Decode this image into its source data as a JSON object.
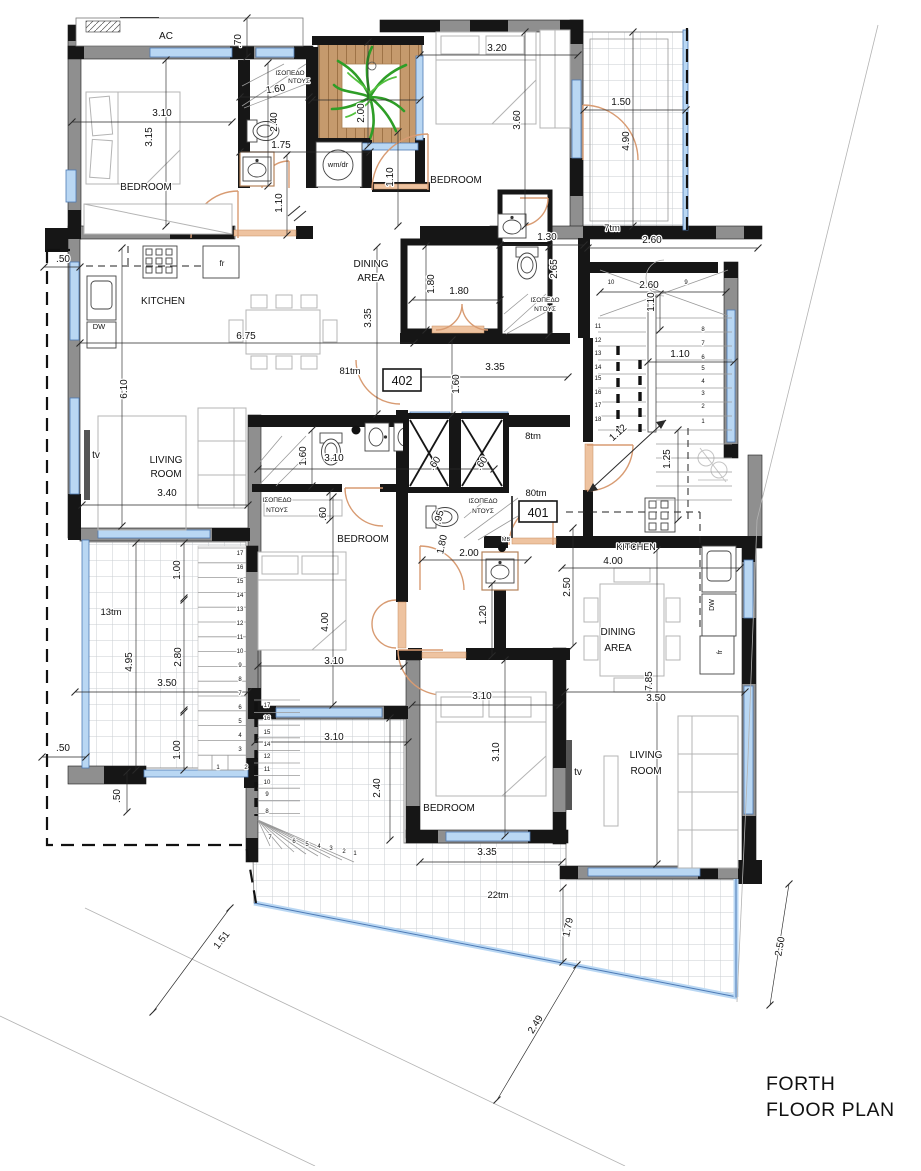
{
  "title": {
    "line1": "FORTH",
    "line2": "FLOOR PLAN"
  },
  "units": {
    "u402": "402",
    "u401": "401"
  },
  "colors": {
    "wall_gray": "#8f8f8f",
    "wall_black": "#161616",
    "window_blue": "#b9d7f3",
    "door_orange": "#d89b72",
    "deck_wood": "#c59a6d",
    "plant_green": "#2e9e27",
    "tile_line": "#c9cdd2",
    "dim_line": "#2a2a2a"
  },
  "labels": [
    {
      "n": "room-label-bedroom-nw",
      "t": "BEDROOM",
      "x": 146,
      "y": 190,
      "s": 10
    },
    {
      "n": "room-label-bedroom-ne",
      "t": "BEDROOM",
      "x": 456,
      "y": 183,
      "s": 10
    },
    {
      "n": "room-label-dining-402-1",
      "t": "DINING",
      "x": 371,
      "y": 267,
      "s": 10
    },
    {
      "n": "room-label-dining-402-2",
      "t": "AREA",
      "x": 371,
      "y": 281,
      "s": 10
    },
    {
      "n": "room-label-kitchen-402",
      "t": "KITCHEN",
      "x": 163,
      "y": 304,
      "s": 10
    },
    {
      "n": "room-label-living-402-1",
      "t": "LIVING",
      "x": 166,
      "y": 463,
      "s": 10
    },
    {
      "n": "room-label-living-402-2",
      "t": "ROOM",
      "x": 166,
      "y": 477,
      "s": 10
    },
    {
      "n": "room-label-bedroom-mid",
      "t": "BEDROOM",
      "x": 363,
      "y": 542,
      "s": 10
    },
    {
      "n": "room-label-kitchen-401",
      "t": "KITCHEN",
      "x": 636,
      "y": 550,
      "s": 9
    },
    {
      "n": "room-label-dining-401-1",
      "t": "DINING",
      "x": 618,
      "y": 635,
      "s": 10
    },
    {
      "n": "room-label-dining-401-2",
      "t": "AREA",
      "x": 618,
      "y": 651,
      "s": 10
    },
    {
      "n": "room-label-living-401-1",
      "t": "LIVING",
      "x": 646,
      "y": 758,
      "s": 10
    },
    {
      "n": "room-label-living-401-2",
      "t": "ROOM",
      "x": 646,
      "y": 774,
      "s": 10
    },
    {
      "n": "room-label-bedroom-s",
      "t": "BEDROOM",
      "x": 449,
      "y": 811,
      "s": 10
    },
    {
      "n": "fixture-label-ac",
      "t": "AC",
      "x": 166,
      "y": 39,
      "s": 10
    },
    {
      "n": "fixture-label-wmdr",
      "t": "wm/dr",
      "x": 338,
      "y": 167,
      "s": 7.5
    },
    {
      "n": "fixture-label-tv-402",
      "t": "tv",
      "x": 96,
      "y": 458,
      "s": 10
    },
    {
      "n": "fixture-label-tv-401",
      "t": "tv",
      "x": 578,
      "y": 775,
      "s": 10
    },
    {
      "n": "fixture-label-fr-402",
      "t": "fr",
      "x": 222,
      "y": 266,
      "s": 8
    },
    {
      "n": "fixture-label-fr-401",
      "t": "fr",
      "x": 722,
      "y": 652,
      "s": 7,
      "r": -90
    },
    {
      "n": "fixture-label-dw-402",
      "t": "DW",
      "x": 99,
      "y": 329,
      "s": 7.5
    },
    {
      "n": "fixture-label-dw-401",
      "t": "DW",
      "x": 714,
      "y": 605,
      "s": 7,
      "r": -90
    },
    {
      "n": "fixture-label-mb",
      "t": "MB",
      "x": 506,
      "y": 541,
      "s": 5.5
    },
    {
      "n": "shower-label-nw-1",
      "t": "ΙΣΟΠΕΔΟ",
      "x": 290,
      "y": 75,
      "s": 6.5
    },
    {
      "n": "shower-label-nw-2",
      "t": "ΝΤΟΥΣ",
      "x": 299,
      "y": 83,
      "s": 6.5
    },
    {
      "n": "shower-label-wc-1",
      "t": "ΙΣΟΠΕΔΟ",
      "x": 545,
      "y": 302,
      "s": 6.5
    },
    {
      "n": "shower-label-wc-2",
      "t": "ΝΤΟΥΣ",
      "x": 545,
      "y": 311,
      "s": 6.5
    },
    {
      "n": "shower-label-mid-1",
      "t": "ΙΣΟΠΕΔΟ",
      "x": 277,
      "y": 502,
      "s": 6.5
    },
    {
      "n": "shower-label-mid-2",
      "t": "ΝΤΟΥΣ",
      "x": 277,
      "y": 512,
      "s": 6.5
    },
    {
      "n": "shower-label-401-1",
      "t": "ΙΣΟΠΕΔΟ",
      "x": 483,
      "y": 503,
      "s": 6.5
    },
    {
      "n": "shower-label-401-2",
      "t": "ΝΤΟΥΣ",
      "x": 483,
      "y": 513,
      "s": 6.5
    },
    {
      "n": "area-label-81tm",
      "t": "81tm",
      "x": 350,
      "y": 374,
      "s": 9.5
    },
    {
      "n": "area-label-7tm",
      "t": "7tm",
      "x": 612,
      "y": 231,
      "s": 9.5
    },
    {
      "n": "area-label-8tm",
      "t": "8tm",
      "x": 533,
      "y": 439,
      "s": 9.5
    },
    {
      "n": "area-label-80tm",
      "t": "80tm",
      "x": 536,
      "y": 496,
      "s": 9.5
    },
    {
      "n": "area-label-13tm",
      "t": "13tm",
      "x": 111,
      "y": 615,
      "s": 9.5
    },
    {
      "n": "area-label-22tm",
      "t": "22tm",
      "x": 498,
      "y": 898,
      "s": 9.5
    },
    {
      "n": "dim",
      ".t": "",
      "t": ".70",
      "x": 241,
      "y": 41,
      "s": 10,
      "r": -90
    },
    {
      "n": "dim",
      "t": "3.20",
      "x": 497,
      "y": 51,
      "s": 10
    },
    {
      "n": "dim",
      "t": "3.10",
      "x": 162,
      "y": 116,
      "s": 10
    },
    {
      "n": "dim",
      "t": "3.15",
      "x": 152,
      "y": 137,
      "s": 10,
      "r": -90
    },
    {
      "n": "dim",
      "t": "1.60",
      "x": 276,
      "y": 92,
      "s": 10,
      "r": -8
    },
    {
      "n": "dim",
      "t": "2.40",
      "x": 277,
      "y": 122,
      "s": 10,
      "r": -90
    },
    {
      "n": "dim",
      "t": "1.75",
      "x": 281,
      "y": 148,
      "s": 10
    },
    {
      "n": "dim",
      "t": "1.10",
      "x": 282,
      "y": 203,
      "s": 10,
      "r": -90
    },
    {
      "n": "dim",
      "t": "2.00",
      "x": 364,
      "y": 113,
      "s": 10,
      "r": -90
    },
    {
      "n": "dim",
      "t": "3.60",
      "x": 520,
      "y": 120,
      "s": 10,
      "r": -90
    },
    {
      "n": "dim",
      "t": "1.10",
      "x": 393,
      "y": 177,
      "s": 10,
      "r": -90
    },
    {
      "n": "dim",
      "t": "1.50",
      "x": 621,
      "y": 105,
      "s": 10
    },
    {
      "n": "dim",
      "t": "4.90",
      "x": 629,
      "y": 141,
      "s": 10,
      "r": -90
    },
    {
      "n": "dim",
      "t": "1.30",
      "x": 547,
      "y": 240,
      "s": 10
    },
    {
      "n": "dim",
      "t": "2.60",
      "x": 652,
      "y": 243,
      "s": 10
    },
    {
      "n": "dim",
      "t": "2.65",
      "x": 557,
      "y": 269,
      "s": 10,
      "r": -90
    },
    {
      "n": "dim",
      "t": "1.80",
      "x": 434,
      "y": 284,
      "s": 10,
      "r": -90
    },
    {
      "n": "dim",
      "t": "1.80",
      "x": 459,
      "y": 294,
      "s": 10
    },
    {
      "n": "dim",
      "t": "2.60",
      "x": 649,
      "y": 288,
      "s": 10
    },
    {
      "n": "dim",
      "t": "1.10",
      "x": 654,
      "y": 302,
      "s": 10,
      "r": -90
    },
    {
      "n": "dim",
      "t": "1.10",
      "x": 680,
      "y": 357,
      "s": 10
    },
    {
      "n": "dim",
      "t": "3.35",
      "x": 495,
      "y": 370,
      "s": 10
    },
    {
      "n": "dim",
      "t": "1.60",
      "x": 459,
      "y": 384,
      "s": 10,
      "r": -90
    },
    {
      "n": "dim",
      "t": "3.35",
      "x": 371,
      "y": 318,
      "s": 10,
      "r": -90
    },
    {
      "n": "dim",
      "t": "6.75",
      "x": 246,
      "y": 339,
      "s": 10
    },
    {
      "n": "dim",
      "t": "6.10",
      "x": 127,
      "y": 389,
      "s": 10,
      "r": -90
    },
    {
      "n": "dim",
      "t": "3.40",
      "x": 167,
      "y": 496,
      "s": 10
    },
    {
      "n": "dim",
      "t": "1.60",
      "x": 306,
      "y": 456,
      "s": 10,
      "r": -90
    },
    {
      "n": "dim",
      "t": "3.10",
      "x": 334,
      "y": 461,
      "s": 10
    },
    {
      "n": "dim",
      "t": ".60",
      "x": 437,
      "y": 465,
      "s": 10,
      "r": -55
    },
    {
      "n": "dim",
      "t": ".60",
      "x": 484,
      "y": 465,
      "s": 10,
      "r": -55
    },
    {
      "n": "dim",
      "t": "1.12",
      "x": 620,
      "y": 435,
      "s": 10,
      "r": -42
    },
    {
      "n": "dim",
      "t": "1.25",
      "x": 670,
      "y": 459,
      "s": 10,
      "r": -90
    },
    {
      "n": "dim",
      "t": ".60",
      "x": 326,
      "y": 514,
      "s": 10,
      "r": -90
    },
    {
      "n": "dim",
      "t": ".95",
      "x": 442,
      "y": 518,
      "s": 10,
      "r": -75
    },
    {
      "n": "dim",
      "t": "1.80",
      "x": 445,
      "y": 545,
      "s": 10,
      "r": -78
    },
    {
      "n": "dim",
      "t": "2.00",
      "x": 469,
      "y": 556,
      "s": 10
    },
    {
      "n": "dim",
      "t": "1.20",
      "x": 486,
      "y": 615,
      "s": 10,
      "r": -90
    },
    {
      "n": "dim",
      "t": "4.00",
      "x": 328,
      "y": 622,
      "s": 10,
      "r": -90
    },
    {
      "n": "dim",
      "t": "3.10",
      "x": 334,
      "y": 664,
      "s": 10
    },
    {
      "n": "dim",
      "t": "3.10",
      "x": 334,
      "y": 740,
      "s": 10
    },
    {
      "n": "dim",
      "t": "2.40",
      "x": 380,
      "y": 788,
      "s": 10,
      "r": -90
    },
    {
      "n": "dim",
      "t": "4.00",
      "x": 613,
      "y": 564,
      "s": 10
    },
    {
      "n": "dim",
      "t": "2.50",
      "x": 570,
      "y": 587,
      "s": 10,
      "r": -90
    },
    {
      "n": "dim",
      "t": "7.85",
      "x": 652,
      "y": 681,
      "s": 10,
      "r": -90
    },
    {
      "n": "dim",
      "t": "3.50",
      "x": 656,
      "y": 701,
      "s": 10
    },
    {
      "n": "dim",
      "t": "3.10",
      "x": 482,
      "y": 699,
      "s": 10
    },
    {
      "n": "dim",
      "t": "3.10",
      "x": 499,
      "y": 752,
      "s": 10,
      "r": -90
    },
    {
      "n": "dim",
      "t": "3.35",
      "x": 487,
      "y": 855,
      "s": 10
    },
    {
      "n": "dim",
      "t": "1.00",
      "x": 180,
      "y": 570,
      "s": 10,
      "r": -90
    },
    {
      "n": "dim",
      "t": "4.95",
      "x": 132,
      "y": 662,
      "s": 10,
      "r": -90
    },
    {
      "n": "dim",
      "t": "2.80",
      "x": 181,
      "y": 657,
      "s": 10,
      "r": -90
    },
    {
      "n": "dim",
      "t": "3.50",
      "x": 167,
      "y": 686,
      "s": 10
    },
    {
      "n": "dim",
      "t": "1.00",
      "x": 180,
      "y": 750,
      "s": 10,
      "r": -90
    },
    {
      "n": "dim",
      "t": ".50",
      "x": 63,
      "y": 751,
      "s": 10
    },
    {
      "n": "dim",
      "t": ".50",
      "x": 120,
      "y": 796,
      "s": 10,
      "r": -90
    },
    {
      "n": "dim",
      "t": ".50",
      "x": 63,
      "y": 262,
      "s": 10
    },
    {
      "n": "dim",
      "t": "1.79",
      "x": 571,
      "y": 928,
      "s": 10,
      "r": -78
    },
    {
      "n": "dim",
      "t": "2.49",
      "x": 538,
      "y": 1026,
      "s": 10,
      "r": -58
    },
    {
      "n": "dim",
      "t": "1.51",
      "x": 224,
      "y": 942,
      "s": 10,
      "r": -52
    },
    {
      "n": "dim",
      "t": "2.50",
      "x": 783,
      "y": 947,
      "s": 10,
      "r": -80
    },
    {
      "n": "stair-step-num",
      "t": "10",
      "x": 611,
      "y": 284,
      "s": 6
    },
    {
      "n": "stair-step-num",
      "t": "9",
      "x": 686,
      "y": 284,
      "s": 6
    },
    {
      "n": "stair-step-num",
      "t": "11",
      "x": 598,
      "y": 328,
      "s": 6
    },
    {
      "n": "stair-step-num",
      "t": "12",
      "x": 598,
      "y": 342,
      "s": 6
    },
    {
      "n": "stair-step-num",
      "t": "13",
      "x": 598,
      "y": 355,
      "s": 6
    },
    {
      "n": "stair-step-num",
      "t": "14",
      "x": 598,
      "y": 369,
      "s": 6
    },
    {
      "n": "stair-step-num",
      "t": "15",
      "x": 598,
      "y": 380,
      "s": 6
    },
    {
      "n": "stair-step-num",
      "t": "16",
      "x": 598,
      "y": 394,
      "s": 6
    },
    {
      "n": "stair-step-num",
      "t": "17",
      "x": 598,
      "y": 407,
      "s": 6
    },
    {
      "n": "stair-step-num",
      "t": "18",
      "x": 598,
      "y": 421,
      "s": 6
    },
    {
      "n": "stair-step-num",
      "t": "8",
      "x": 703,
      "y": 331,
      "s": 6
    },
    {
      "n": "stair-step-num",
      "t": "7",
      "x": 703,
      "y": 345,
      "s": 6
    },
    {
      "n": "stair-step-num",
      "t": "6",
      "x": 703,
      "y": 359,
      "s": 6
    },
    {
      "n": "stair-step-num",
      "t": "5",
      "x": 703,
      "y": 370,
      "s": 6
    },
    {
      "n": "stair-step-num",
      "t": "4",
      "x": 703,
      "y": 383,
      "s": 6
    },
    {
      "n": "stair-step-num",
      "t": "3",
      "x": 703,
      "y": 395,
      "s": 6
    },
    {
      "n": "stair-step-num",
      "t": "2",
      "x": 703,
      "y": 408,
      "s": 6
    },
    {
      "n": "stair-step-num",
      "t": "1",
      "x": 703,
      "y": 423,
      "s": 6
    },
    {
      "n": "stair-step-num",
      "t": "17",
      "x": 240,
      "y": 555,
      "s": 6
    },
    {
      "n": "stair-step-num",
      "t": "16",
      "x": 240,
      "y": 569,
      "s": 6
    },
    {
      "n": "stair-step-num",
      "t": "15",
      "x": 240,
      "y": 583,
      "s": 6
    },
    {
      "n": "stair-step-num",
      "t": "14",
      "x": 240,
      "y": 597,
      "s": 6
    },
    {
      "n": "stair-step-num",
      "t": "13",
      "x": 240,
      "y": 611,
      "s": 6
    },
    {
      "n": "stair-step-num",
      "t": "12",
      "x": 240,
      "y": 625,
      "s": 6
    },
    {
      "n": "stair-step-num",
      "t": "11",
      "x": 240,
      "y": 639,
      "s": 6
    },
    {
      "n": "stair-step-num",
      "t": "10",
      "x": 240,
      "y": 653,
      "s": 6
    },
    {
      "n": "stair-step-num",
      "t": "9",
      "x": 240,
      "y": 667,
      "s": 6
    },
    {
      "n": "stair-step-num",
      "t": "8",
      "x": 240,
      "y": 681,
      "s": 6
    },
    {
      "n": "stair-step-num",
      "t": "7",
      "x": 240,
      "y": 695,
      "s": 6
    },
    {
      "n": "stair-step-num",
      "t": "6",
      "x": 240,
      "y": 709,
      "s": 6
    },
    {
      "n": "stair-step-num",
      "t": "5",
      "x": 240,
      "y": 723,
      "s": 6
    },
    {
      "n": "stair-step-num",
      "t": "4",
      "x": 240,
      "y": 737,
      "s": 6
    },
    {
      "n": "stair-step-num",
      "t": "3",
      "x": 240,
      "y": 751,
      "s": 6
    },
    {
      "n": "stair-step-num",
      "t": "2",
      "x": 246,
      "y": 769,
      "s": 6
    },
    {
      "n": "stair-step-num",
      "t": "1",
      "x": 218,
      "y": 769,
      "s": 6
    },
    {
      "n": "stair-step-num",
      "t": "17",
      "x": 267,
      "y": 707,
      "s": 6
    },
    {
      "n": "stair-step-num",
      "t": "16",
      "x": 267,
      "y": 720,
      "s": 6
    },
    {
      "n": "stair-step-num",
      "t": "15",
      "x": 267,
      "y": 734,
      "s": 6
    },
    {
      "n": "stair-step-num",
      "t": "14",
      "x": 267,
      "y": 746,
      "s": 6
    },
    {
      "n": "stair-step-num",
      "t": "12",
      "x": 267,
      "y": 758,
      "s": 6
    },
    {
      "n": "stair-step-num",
      "t": "11",
      "x": 267,
      "y": 771,
      "s": 6
    },
    {
      "n": "stair-step-num",
      "t": "10",
      "x": 267,
      "y": 784,
      "s": 6
    },
    {
      "n": "stair-step-num",
      "t": "9",
      "x": 267,
      "y": 796,
      "s": 6
    },
    {
      "n": "stair-step-num",
      "t": "8",
      "x": 267,
      "y": 813,
      "s": 6
    },
    {
      "n": "stair-step-num",
      "t": "7",
      "x": 270,
      "y": 839,
      "s": 6
    },
    {
      "n": "stair-step-num",
      "t": "6",
      "x": 294,
      "y": 843,
      "s": 6
    },
    {
      "n": "stair-step-num",
      "t": "5",
      "x": 307,
      "y": 846,
      "s": 6
    },
    {
      "n": "stair-step-num",
      "t": "4",
      "x": 319,
      "y": 848,
      "s": 6
    },
    {
      "n": "stair-step-num",
      "t": "3",
      "x": 331,
      "y": 850,
      "s": 6
    },
    {
      "n": "stair-step-num",
      "t": "2",
      "x": 344,
      "y": 853,
      "s": 6
    },
    {
      "n": "stair-step-num",
      "t": "1",
      "x": 355,
      "y": 855,
      "s": 6
    }
  ]
}
